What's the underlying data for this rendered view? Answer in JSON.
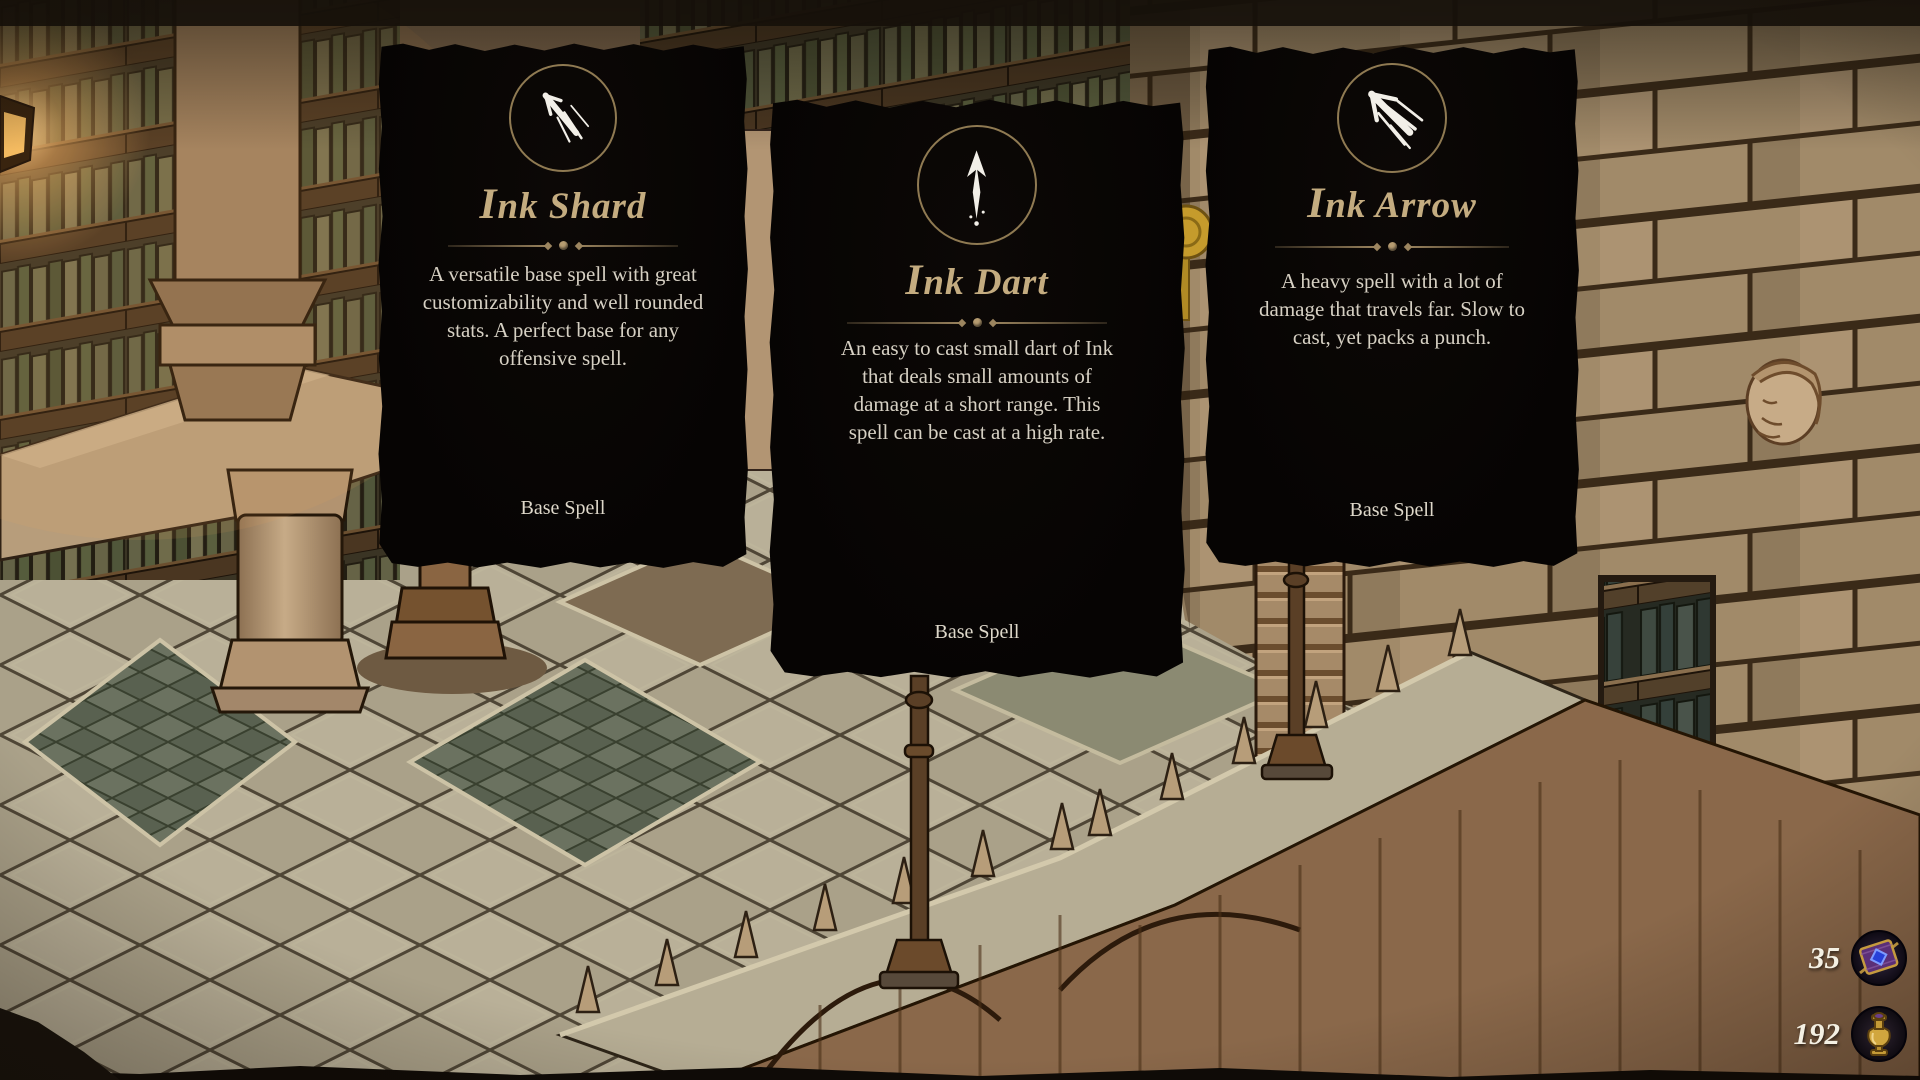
{
  "cards": [
    {
      "icon": "ink-shard-icon",
      "title": "Ink Shard",
      "description": "A versatile base spell with great customizability and well rounded stats. A perfect base for any offensive spell.",
      "type_label": "Base Spell"
    },
    {
      "icon": "ink-dart-icon",
      "title": "Ink Dart",
      "description": "An easy to cast small dart of Ink that deals small amounts of damage at a short range. This spell can be cast at a high rate.",
      "type_label": "Base Spell"
    },
    {
      "icon": "ink-arrow-icon",
      "title": "Ink Arrow",
      "description": "A heavy spell with a lot of damage that travels far. Slow to cast, yet packs a punch.",
      "type_label": "Base Spell"
    }
  ],
  "hud": {
    "counters": [
      {
        "icon": "spellbook-icon",
        "value": "35"
      },
      {
        "icon": "ink-vial-icon",
        "value": "192"
      }
    ]
  },
  "colors": {
    "card_background": "#070503",
    "title_gold": "#c4ac80",
    "divider_gold": "#9c855f",
    "body_text": "#d6d0c3",
    "counter_text": "#f4f0e3",
    "icon_white": "#f2efe8"
  }
}
